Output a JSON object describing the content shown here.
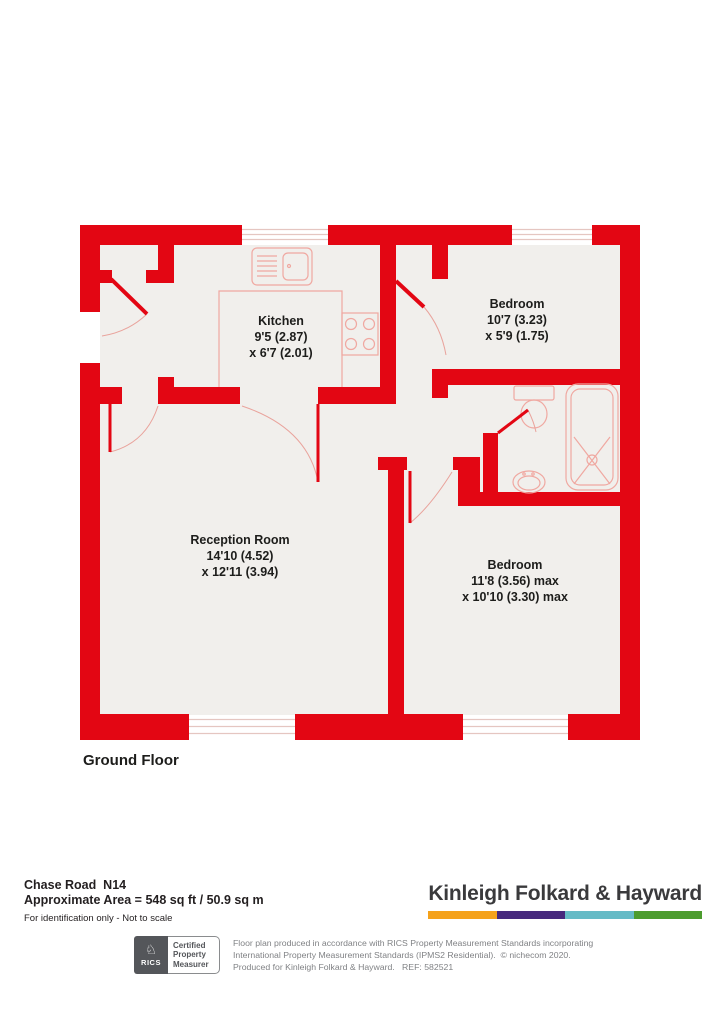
{
  "plan": {
    "floor_label": "Ground Floor",
    "rooms": [
      {
        "name": "Kitchen",
        "dim1": "9'5 (2.87)",
        "dim2": "x 6'7 (2.01)"
      },
      {
        "name": "Bedroom",
        "dim1": "10'7 (3.23)",
        "dim2": "x 5'9 (1.75)"
      },
      {
        "name": "Reception Room",
        "dim1": "14'10 (4.52)",
        "dim2": "x 12'11 (3.94)"
      },
      {
        "name": "Bedroom",
        "dim1": "11'8 (3.56) max",
        "dim2": "x 10'10 (3.30) max"
      }
    ],
    "colors": {
      "wall": "#e30613",
      "floor": "#f1efec",
      "fixture": "#f0a8a1"
    }
  },
  "footer": {
    "address": "Chase Road  N14",
    "area_line": "Approximate Area = 548 sq ft / 50.9 sq m",
    "disclaimer": "For identification only - Not to scale",
    "brand_name": "Kinleigh Folkard & Hayward",
    "brand_colors": [
      "#F5A21B",
      "#46287D",
      "#65BBC6",
      "#4C9C2E"
    ],
    "rics_badge": {
      "knight_icon": "♘",
      "wordmark": "RICS",
      "cert_lines": [
        "Certified",
        "Property",
        "Measurer"
      ]
    },
    "fine_print": [
      "Floor plan produced in accordance with RICS Property Measurement Standards incorporating",
      "International Property Measurement Standards (IPMS2 Residential).  © nichecom 2020.",
      "Produced for Kinleigh Folkard & Hayward.   REF: 582521"
    ]
  }
}
